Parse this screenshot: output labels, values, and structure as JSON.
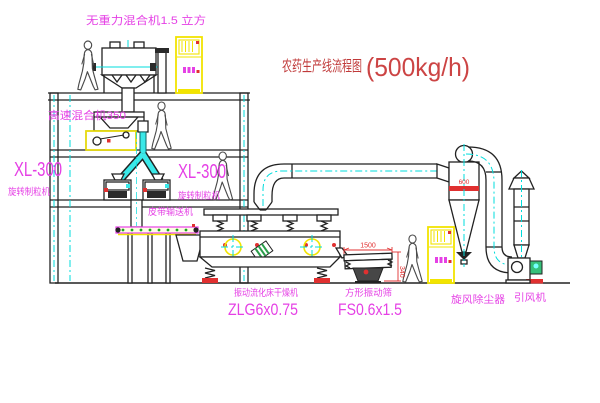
{
  "title": {
    "cn": "农药生产线流程图",
    "capacity": "(500kg/h)"
  },
  "labels": {
    "gravity_mixer": "无重力混合机1.5 立方",
    "high_speed_mixer": "高速混合机350",
    "granulator_model_left": "XL-300",
    "granulator_name_left": "旋转制粒机",
    "granulator_model_right": "XL-300",
    "granulator_name_right": "旋转制粒机",
    "belt_conveyor": "皮带输送机",
    "dryer_name": "振动流化床干燥机",
    "dryer_model": "ZLG6x0.75",
    "sieve_name": "方形振动筛",
    "sieve_model": "FS0.6x1.5",
    "cyclone": "旋风除尘器",
    "fan": "引风机"
  },
  "dimensions": {
    "sieve_length": "1500",
    "sieve_height": "340",
    "cyclone_band": "600"
  },
  "colors": {
    "label_magenta": "#e540e5",
    "title_red": "#c03a3a",
    "dimension_red": "#e03030",
    "cad_yellow": "#f2e400",
    "cad_cyan": "#00dcdc",
    "line_black": "#222222"
  }
}
